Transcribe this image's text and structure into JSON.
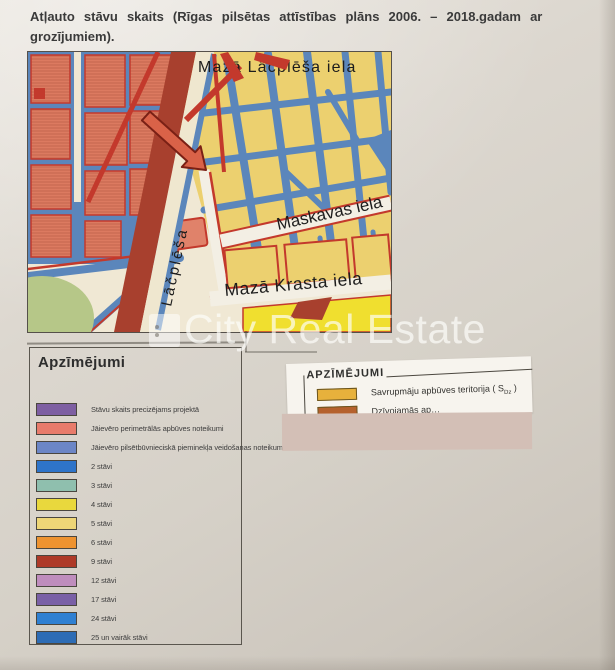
{
  "title": {
    "line1": "Atļauto stāvu skaits (Rīgas pilsētas attīstības plāns 2006. – 2018.gadam ar",
    "line2": "grozījumiem)."
  },
  "map": {
    "street_labels": {
      "top": "Mazā Lāčplēša iela",
      "maskavas": "Maskavas iela",
      "maza_krasta": "Mazā Krasta iela",
      "lacplesa": "Lāčplēša"
    },
    "colors": {
      "background": "#f0e8d4",
      "street_blue": "#5b86bb",
      "block_salmon": "#dc7a60",
      "block_yellow": "#ecd06f",
      "road_dark_red": "#a8402e",
      "outline_red": "#c3392c",
      "green_area": "#b6c788",
      "bright_yellow": "#f0df2f",
      "street_white": "#f3efe4",
      "arrow": "#d96248"
    }
  },
  "legend_left": {
    "title": "Apzīmējumi",
    "items": [
      {
        "color": "#7e5fa2",
        "label": "Stāvu skaits precizējams projektā"
      },
      {
        "color": "#e87b6b",
        "label": "Jāievēro perimetrālās apbūves noteikumi"
      },
      {
        "color": "#6c86c6",
        "label": "Jāievēro pilsētbūvnieciskā pieminekļa veidošanas noteikumi"
      },
      {
        "color": "#2e74c9",
        "label": "2 stāvi"
      },
      {
        "color": "#8fbfae",
        "label": "3 stāvi"
      },
      {
        "color": "#e9d83d",
        "label": "4 stāvi"
      },
      {
        "color": "#eed677",
        "label": "5 stāvi"
      },
      {
        "color": "#ee9330",
        "label": "6 stāvi"
      },
      {
        "color": "#ae3a28",
        "label": "9 stāvi"
      },
      {
        "color": "#bf8dbd",
        "label": "12 stāvi"
      },
      {
        "color": "#7a60a6",
        "label": "17 stāvi"
      },
      {
        "color": "#2f80d2",
        "label": "24 stāvi"
      },
      {
        "color": "#2d6cb5",
        "label": "25 un vairāk stāvi"
      }
    ]
  },
  "legend_right": {
    "title": "APZĪMĒJUMI",
    "items": [
      {
        "color": "#e7b13c",
        "label": "Savrupmāju apbūves teritorija ( S",
        "subscript": "Dz",
        "suffix": " )"
      },
      {
        "color": "#b5612d",
        "label": "Dzīvojamās ap…",
        "subscript": "",
        "suffix": ""
      }
    ]
  },
  "watermark": {
    "text": "City Real Estate"
  }
}
